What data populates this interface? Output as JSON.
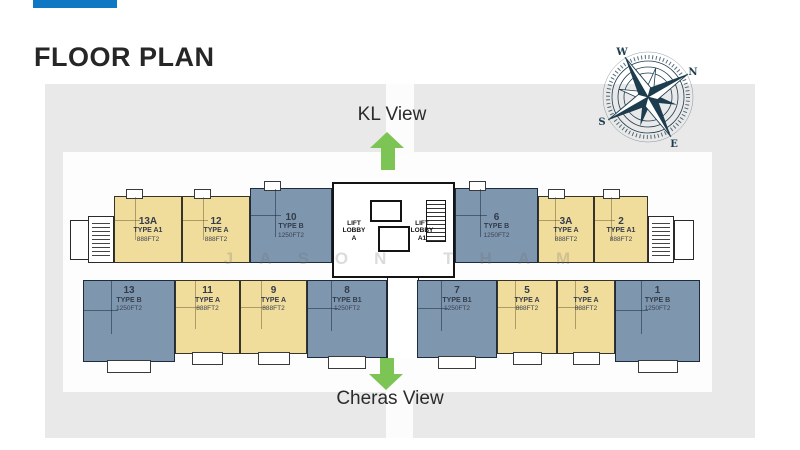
{
  "slide": {
    "title": "FLOOR PLAN"
  },
  "views": {
    "top": {
      "label": "KL View"
    },
    "bottom": {
      "label": "Cheras View"
    }
  },
  "watermark": {
    "text": "JASON THAM"
  },
  "compass": {
    "labels": {
      "n": "N",
      "e": "E",
      "s": "S",
      "w": "W"
    },
    "rotation_deg": 60
  },
  "core": {
    "lobbies": [
      {
        "label": "LIFT\nLOBBY\nA"
      },
      {
        "label": "LIFT\nLOBBY\nA1"
      }
    ]
  },
  "units": {
    "top_row": [
      {
        "no": "13A",
        "type": "TYPE A1",
        "area": "888FT2",
        "color": "yellow"
      },
      {
        "no": "12",
        "type": "TYPE A",
        "area": "888FT2",
        "color": "yellow"
      },
      {
        "no": "10",
        "type": "TYPE B",
        "area": "1250FT2",
        "color": "blue"
      },
      {
        "no": "6",
        "type": "TYPE B",
        "area": "1250FT2",
        "color": "blue"
      },
      {
        "no": "3A",
        "type": "TYPE A",
        "area": "888FT2",
        "color": "yellow"
      },
      {
        "no": "2",
        "type": "TYPE A1",
        "area": "888FT2",
        "color": "yellow"
      }
    ],
    "bottom_row": [
      {
        "no": "13",
        "type": "TYPE B",
        "area": "1250FT2",
        "color": "blue"
      },
      {
        "no": "11",
        "type": "TYPE A",
        "area": "888FT2",
        "color": "yellow"
      },
      {
        "no": "9",
        "type": "TYPE A",
        "area": "888FT2",
        "color": "yellow"
      },
      {
        "no": "8",
        "type": "TYPE B1",
        "area": "1250FT2",
        "color": "blue"
      },
      {
        "no": "7",
        "type": "TYPE B1",
        "area": "1250FT2",
        "color": "blue"
      },
      {
        "no": "5",
        "type": "TYPE A",
        "area": "888FT2",
        "color": "yellow"
      },
      {
        "no": "3",
        "type": "TYPE A",
        "area": "888FT2",
        "color": "yellow"
      },
      {
        "no": "1",
        "type": "TYPE B",
        "area": "1250FT2",
        "color": "blue"
      }
    ]
  },
  "colors": {
    "accent_blue": "#0E79C2",
    "panel_gray": "#E9E9E9",
    "unit_yellow": "#F0DC9B",
    "unit_blue": "#7E96AE",
    "arrow_green": "#7CC454",
    "compass_navy": "#1D3C4E",
    "wall_dark": "#222222"
  }
}
